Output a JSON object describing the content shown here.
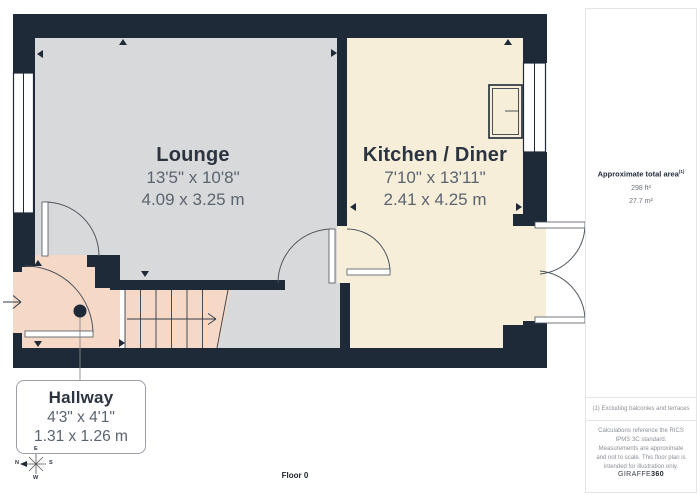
{
  "plan": {
    "rooms": [
      {
        "name": "Lounge",
        "imperial": "13'5\" x 10'8\"",
        "metric": "4.09 x 3.25 m"
      },
      {
        "name": "Kitchen / Diner",
        "imperial": "7'10\" x 13'11\"",
        "metric": "2.41 x 4.25 m"
      },
      {
        "name": "Hallway",
        "imperial": "4'3\" x 4'1\"",
        "metric": "1.31 x 1.26 m"
      }
    ],
    "floor_label": "Floor 0",
    "compass": {
      "n": "N",
      "s": "S",
      "e": "E",
      "w": "W"
    }
  },
  "sidebar": {
    "area_title": "Approximate total area",
    "area_title_sup": "(1)",
    "area_ft": "298 ft²",
    "area_m": "27.7 m²",
    "footnote": "(1) Excluding balconies and terraces",
    "disclaimer": "Calculations reference the RICS IPMS 3C standard. Measurements are approximate and not to scale. This floor plan is intended for illustration only.",
    "brand": "GIRAFFE",
    "brand_bold": "360"
  },
  "colors": {
    "wall": "#1e2a38",
    "lounge_floor": "#d8d9da",
    "kitchen_floor": "#f6eed8",
    "hallway_floor": "#f5d8c6",
    "door_arc": "#4d555e",
    "label_dark": "#2b3440",
    "label_gray": "#5a6470"
  }
}
